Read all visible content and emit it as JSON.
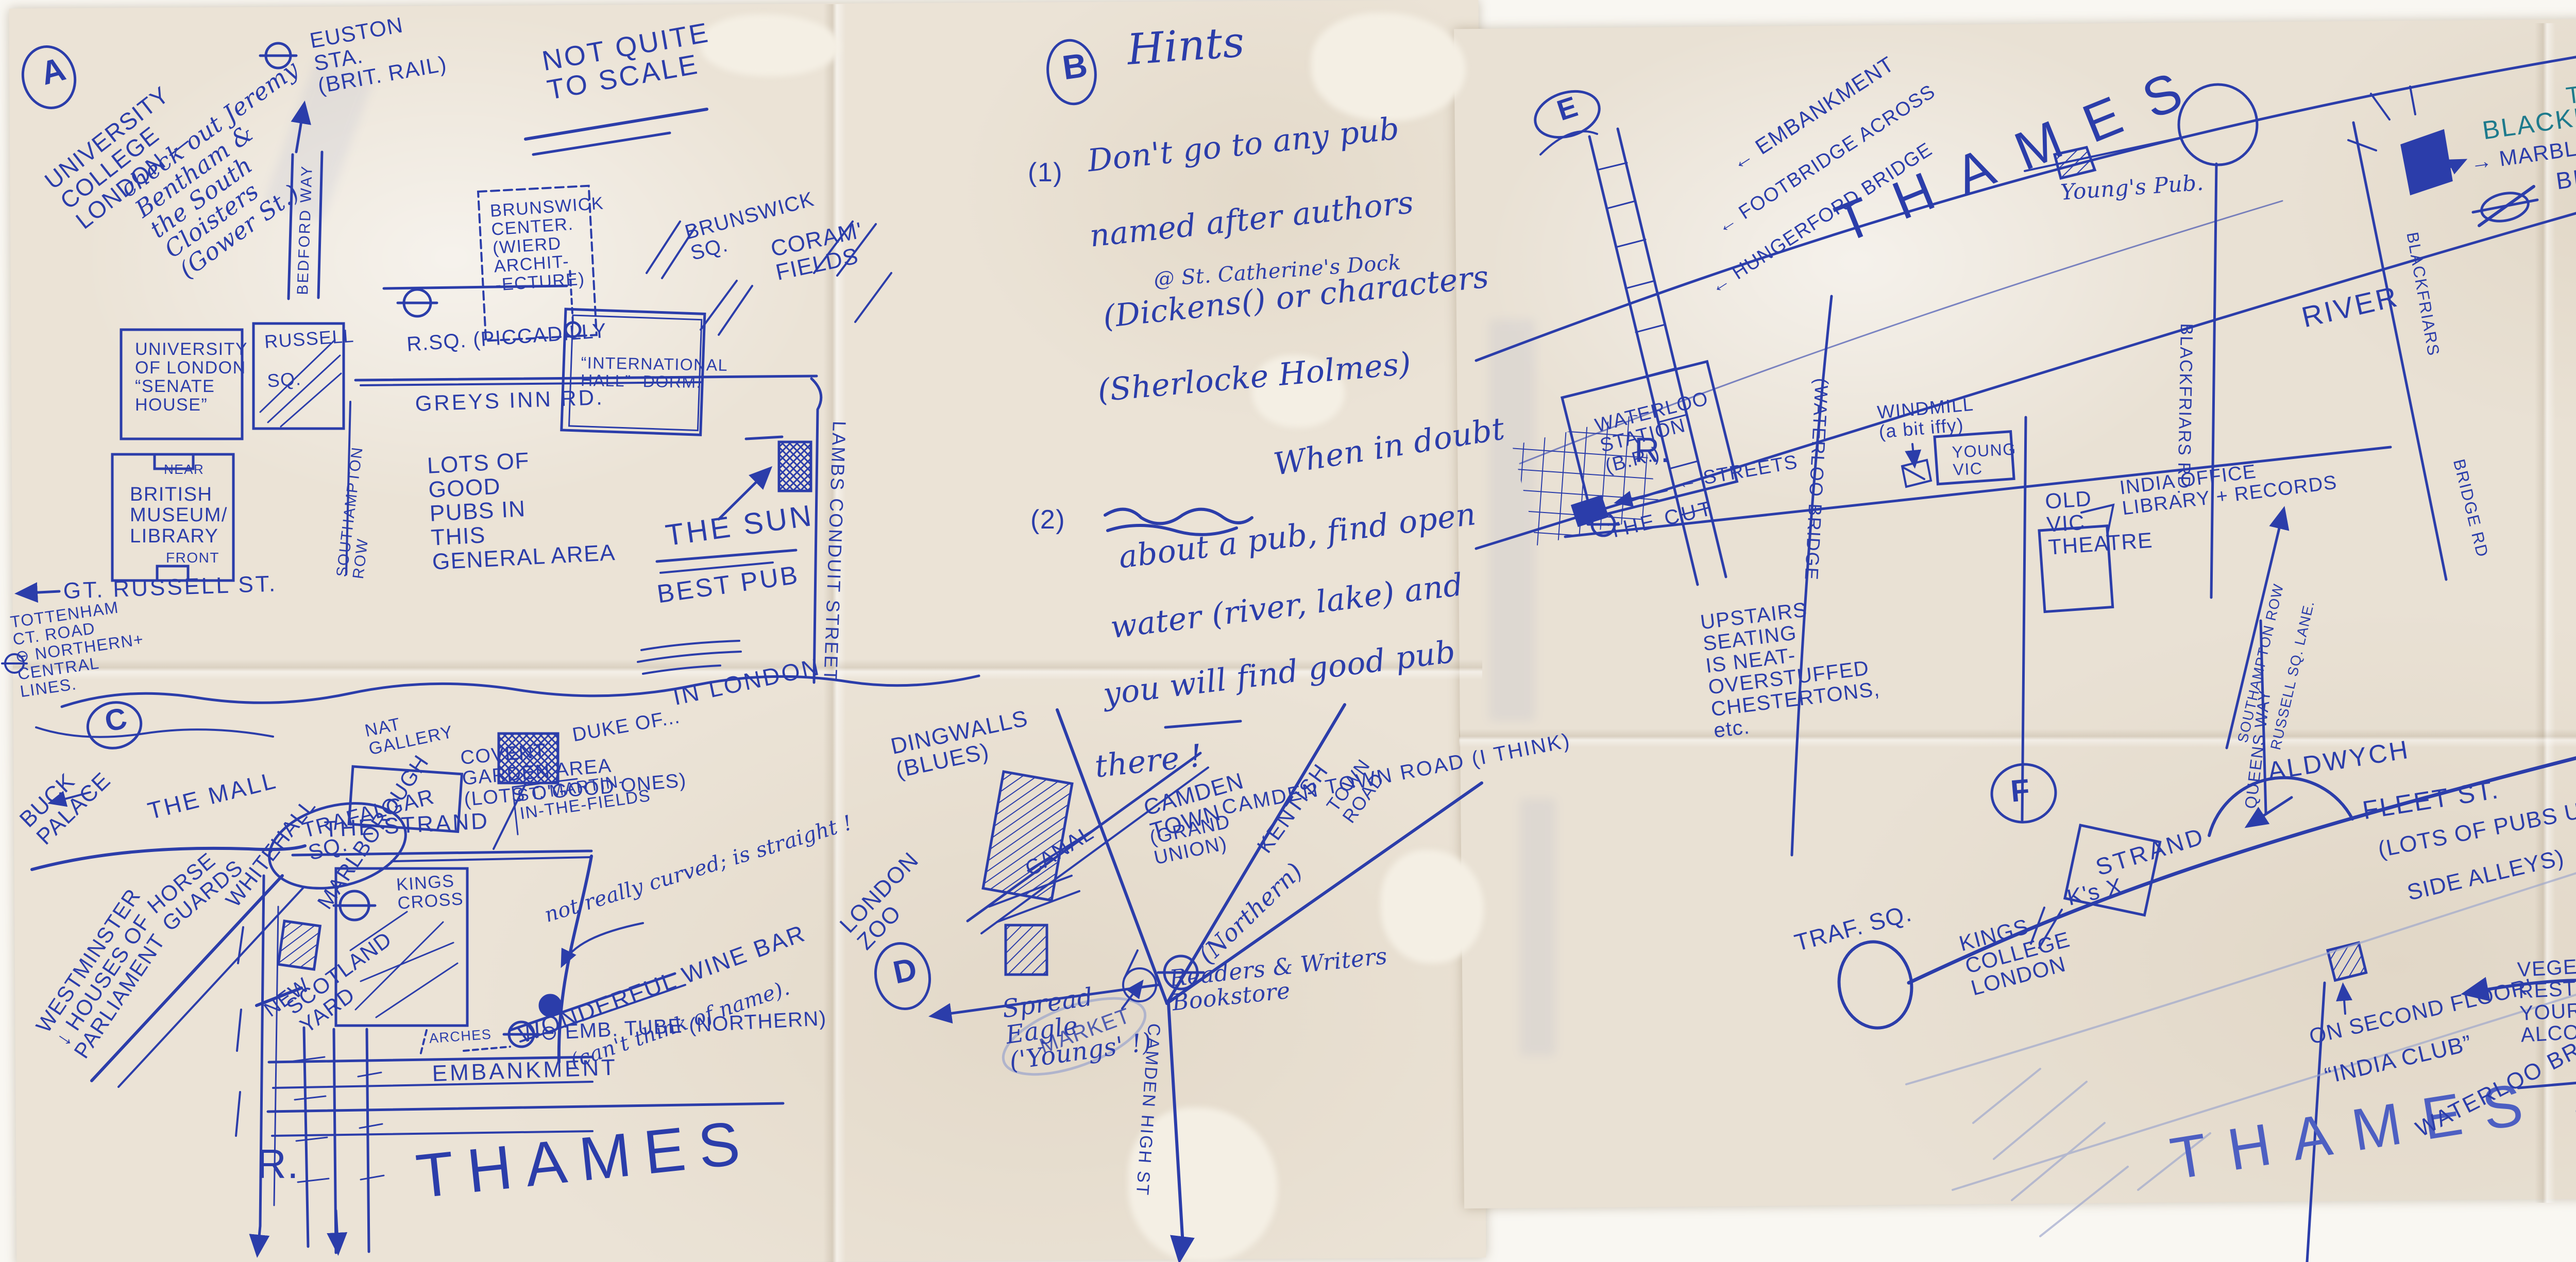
{
  "a": {
    "section": "A",
    "euston": "EUSTON\nSTA.\n(BRIT. RAIL)",
    "not_to_scale": "NOT QUITE\nTO SCALE",
    "ucl": "UNIVERSITY\nCOLLEGE\nLONDON —",
    "ucl_note": "check out Jeremy\nBentham &\nthe South\nCloisters\n(Gower St.)",
    "bedford_way": "BEDFORD WAY",
    "brunswick_center": "BRUNSWICK\nCENTER.\n(WIERD\nARCHIT-\n-ECTURE)",
    "brunswick_sq": "BRUNSWICK\nSQ.",
    "russell_sq_tube": "R.SQ. (PICCADILLY",
    "international_hall": "“INTERNATIONAL\nHALL” -DORM.",
    "corams_fields": "CORAM'\nFIELDS",
    "greys_inn": "GREYS INN RD.",
    "senate_house": "UNIVERSITY\nOF LONDON\n“SENATE\nHOUSE”",
    "russell_sq": "RUSSELL\n\nSQ.",
    "southampton_row": "SOUTHAMPTON\nROW",
    "museum_near": "NEAR",
    "museum": "BRITISH\nMUSEUM/\nLIBRARY",
    "museum_front": "FRONT",
    "gt_russell": "GT. RUSSELL ST.",
    "tottenham": "TOTTENHAM\nCT. ROAD\n⊖ NORTHERN+\nCENTRAL\nLINES.",
    "lots_of_pubs": "LOTS OF\nGOOD\nPUBS IN\nTHIS\nGENERAL AREA",
    "the_sun": "THE SUN",
    "best_pub": "BEST PUB",
    "in_london": "IN LONDON",
    "lambs_conduit": "LAMBS CONDUIT STREET"
  },
  "b": {
    "section": "B",
    "hints_title": "Hints",
    "h1_num": "(1)",
    "h1_line1": "Don't go to any pub",
    "h1_line2": "named after authors",
    "h1_note": "@ St. Catherine's Dock",
    "h1_line3": "(Dickens() or characters",
    "h1_line4": "(Sherlocke Holmes)",
    "h2_num": "(2)",
    "h2_line1": "When in doubt",
    "h2_line2": "about a pub, find open",
    "h2_line3": "water (river, lake) and",
    "h2_line4": "you will find good pub",
    "h2_line5": "there !"
  },
  "c": {
    "section": "C",
    "duke_of": "DUKE OF...",
    "covent": "COVENT\nGARDEN AREA\n(LOTS O'GOOD ONES)",
    "st_martin": "ST. MARTIN-\nIN-THE-FIELDS",
    "nat_gallery": "NAT\nGALLERY",
    "the_mall": "THE MALL",
    "buck_palace": "BUCK\nPALACE",
    "trafalgar": "TRAFALGAR\nSQ.",
    "horse_guards": "HORSE\nGUARDS",
    "whitehall": "WHITEHALL",
    "marlborough": "MARLBOROUGH",
    "scotland_new": "NEW",
    "scotland_yard": "SCOTLAND\nYARD",
    "westminster": "WESTMINSTER\n↓ HOUSES OF\nPARLIAMENT",
    "the_strand": "THE STRAND",
    "kings_cross": "KINGS\nCROSS",
    "curved_note": "not really curved; is straight !",
    "wine_bar": "WONDERFUL WINE BAR",
    "wine_bar_note": "(can't think of name).",
    "arches": "ARCHES",
    "emb_tube": "⊖ EMB. TUBE (NORTHERN)",
    "embankment": "EMBANKMENT",
    "river_r": "R.",
    "thames": "THAMES"
  },
  "d": {
    "section": "D",
    "dingwalls": "DINGWALLS\n(BLUES)",
    "canal": "CANAL",
    "grand_union": "(GRAND\nUNION)",
    "camden_town": "CAMDEN\nTOWN",
    "market": "MARKET",
    "northern": "(Northern)",
    "kentish": "KENTISH",
    "kentish2": "TOWN\nROAD",
    "camden_town_road": "CAMDEN TOWN ROAD (I THINK)",
    "london_zoo": "LONDON\nZOO",
    "spread_eagle": "Spread\nEagle\n('Youngs' !)",
    "readers": "Readers & Writers\nBookstore",
    "camden_high": "CAMDEN HIGH ST"
  },
  "e": {
    "section": "E",
    "embankment": "← EMBANKMENT",
    "footbridge": "← FOOTBRIDGE ACROSS",
    "hungerford": "← HUNGERFORD BRIDGE",
    "thames": "THAMES",
    "river_r": "R.",
    "waterloo_bridge": "(WATERLOO BRIDGE",
    "waterloo_station": "WATERLOO\nSTATION\n(B.R.)",
    "streets": "← STREETS",
    "the_cut": "THE CUT",
    "windmill": "WINDMILL\n(a bit iffy)",
    "young_vic": "YOUNG\nVIC",
    "old_vic": "OLD\nVIC\nTHEATRE",
    "upstairs": "UPSTAIRS\nSEATING\nIS NEAT-\nOVERSTUFFED\nCHESTERTONS,\netc.",
    "blackfriars_rd": "BLACKFRIARS RD.",
    "youngs_pub": "Young's Pub.",
    "india_office": "INDIA OFFICE\nLIBRARY + RECORDS",
    "southampton_row": "SOUTHAMPTON ROW",
    "russell_lane": "RUSSELL SQ. LANE.",
    "the_bf_the": "THE",
    "the_bf": "BLACKFRIARS",
    "beaten": "w/ BEATEN\nCOPPER",
    "marble": "→ MARBLE WALLS",
    "in_a_pub": "IN A\nPUB !",
    "bf_tube_name": "BLACKFRIARS",
    "bf_tube": "TUBE",
    "river": "RIVER",
    "bf_road_v": "BLACKFRIARS",
    "bf_road_v2": "BRIDGE RD"
  },
  "f": {
    "section": "F",
    "aldwych": "ALDWYCH",
    "queens_way": "QUEENS WAY",
    "fleet": "FLEET ST.",
    "fleet2": "(LOTS OF PUBS UP",
    "fleet3": "SIDE ALLEYS)",
    "strand": "STRAND",
    "traf_sq": "TRAF. SQ.",
    "kings_x": "K's X",
    "kings_college": "KINGS\nCOLLEGE\nLONDON",
    "on_second": "ON SECOND FLOOR'",
    "india_club": "“INDIA CLUB”",
    "thames": "THAMES",
    "waterloo_bridge": "WATERLOO BRIDGE",
    "vegetarian": "VEGETARIAN INDIAN\nREST.; TAKE\nYOUR OWN\nALCOHOL.",
    "look_for": "LOOK FOR\nITS SIGN",
    "blackfriars": "BLACKFRIARS"
  }
}
